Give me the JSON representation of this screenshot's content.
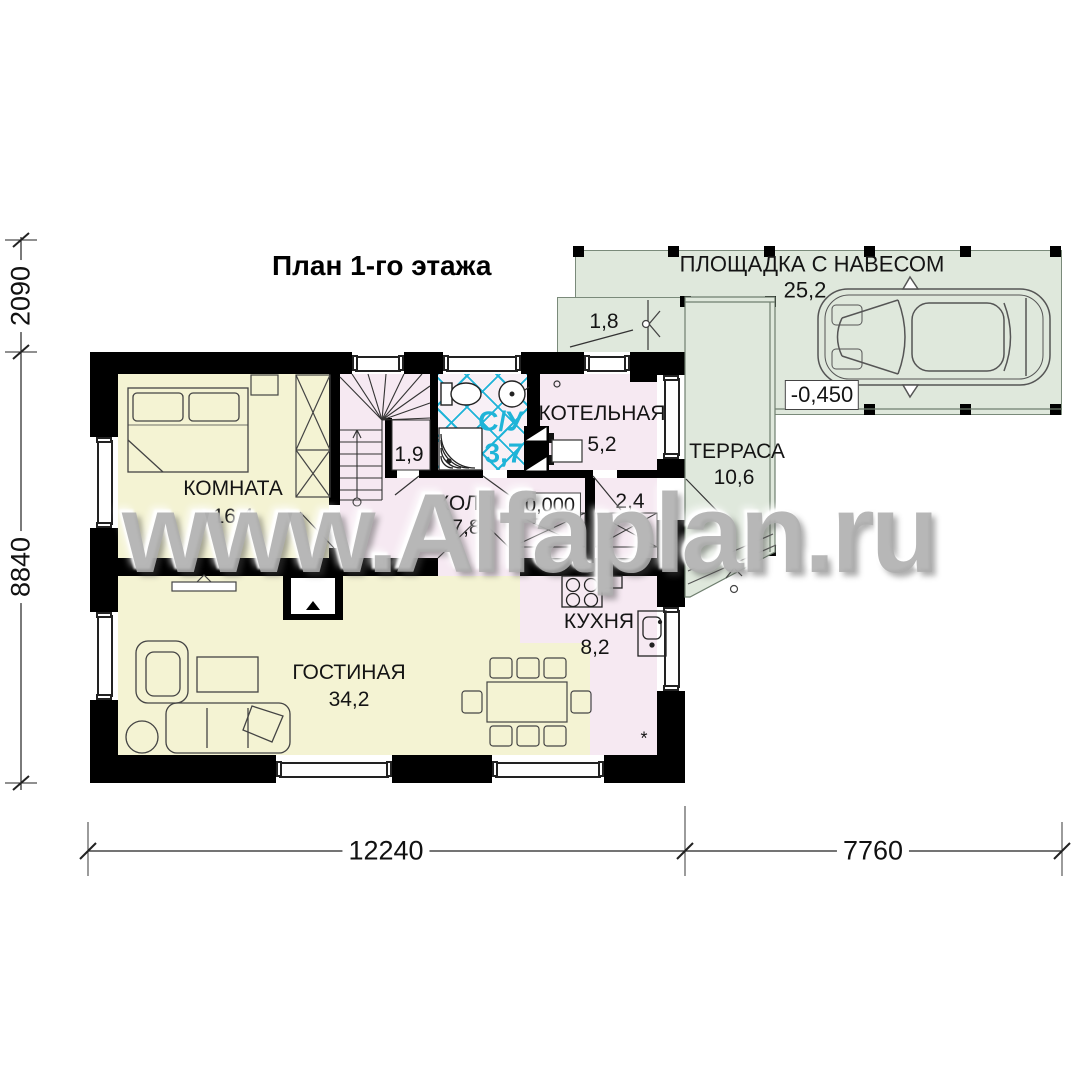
{
  "title": "План 1-го этажа",
  "watermark": "www.Alfaplan.ru",
  "rooms": {
    "bedroom": {
      "name": "КОМНАТА",
      "area": "16,4"
    },
    "hall": {
      "name": "ХОЛЛ",
      "area": "7,8"
    },
    "bathroom": {
      "name": "С/У",
      "area": "3,7"
    },
    "boiler": {
      "name": "КОТЕЛЬНАЯ",
      "area": "5,2"
    },
    "kitchen": {
      "name": "КУХНЯ",
      "area": "8,2"
    },
    "living": {
      "name": "ГОСТИНАЯ",
      "area": "34,2"
    },
    "terrace": {
      "name": "ТЕРРАСА",
      "area": "10,6"
    },
    "carport": {
      "name": "ПЛОЩАДКА С НАВЕСОМ",
      "area": "25,2"
    }
  },
  "annotations": {
    "stair_closet_area": "1,9",
    "entry_porch_area": "1,8",
    "vestibule_area": "2,4",
    "floor_level": "0,000",
    "carport_level": "-0,450",
    "kitchen_mark": "*"
  },
  "dimensions": {
    "left_upper": "2090",
    "left_lower": "8840",
    "bottom_left": "12240",
    "bottom_right": "7760"
  },
  "colors": {
    "room_yellow": "#f4f3d3",
    "room_pink": "#f6e9f2",
    "outdoor_green": "#dfe8dc",
    "bath_bg": "#f8f0f6",
    "tile_cyan": "#1fb4d8",
    "wall_black": "#000000",
    "watermark_gray": "#adadad"
  }
}
